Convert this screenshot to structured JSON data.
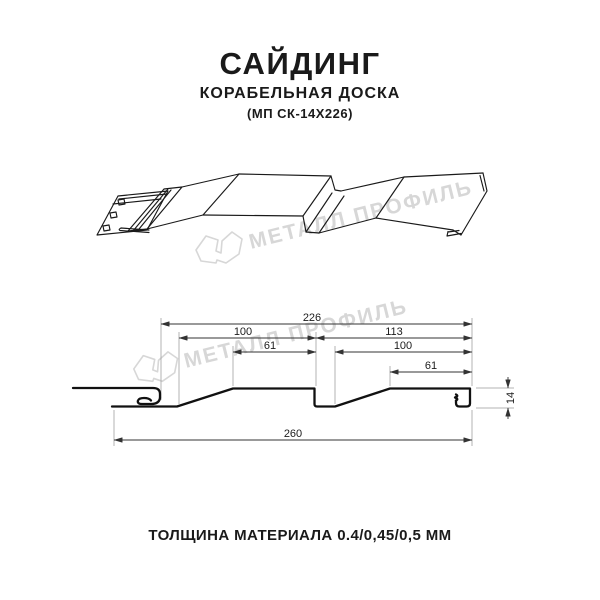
{
  "header": {
    "title": "САЙДИНГ",
    "subtitle": "КОРАБЕЛЬНАЯ ДОСКА",
    "model": "(МП СК-14Х226)"
  },
  "watermark": {
    "text": "МЕТАЛЛ ПРОФИЛЬ",
    "color": "#d7d7d7"
  },
  "footer": {
    "thickness_label": "ТОЛЩИНА МАТЕРИАЛА 0.4/0,45/0,5 ММ"
  },
  "diagram": {
    "type": "siding-profile-cross-section",
    "units": "mm",
    "line_color": "#1a1a1a",
    "dimensions": {
      "overall_width": "260",
      "cover_width": "226",
      "board1_width": "100",
      "board1_flat": "61",
      "board2_segment": "113",
      "board2_width": "100",
      "board2_flat": "61",
      "profile_height": "14"
    }
  }
}
